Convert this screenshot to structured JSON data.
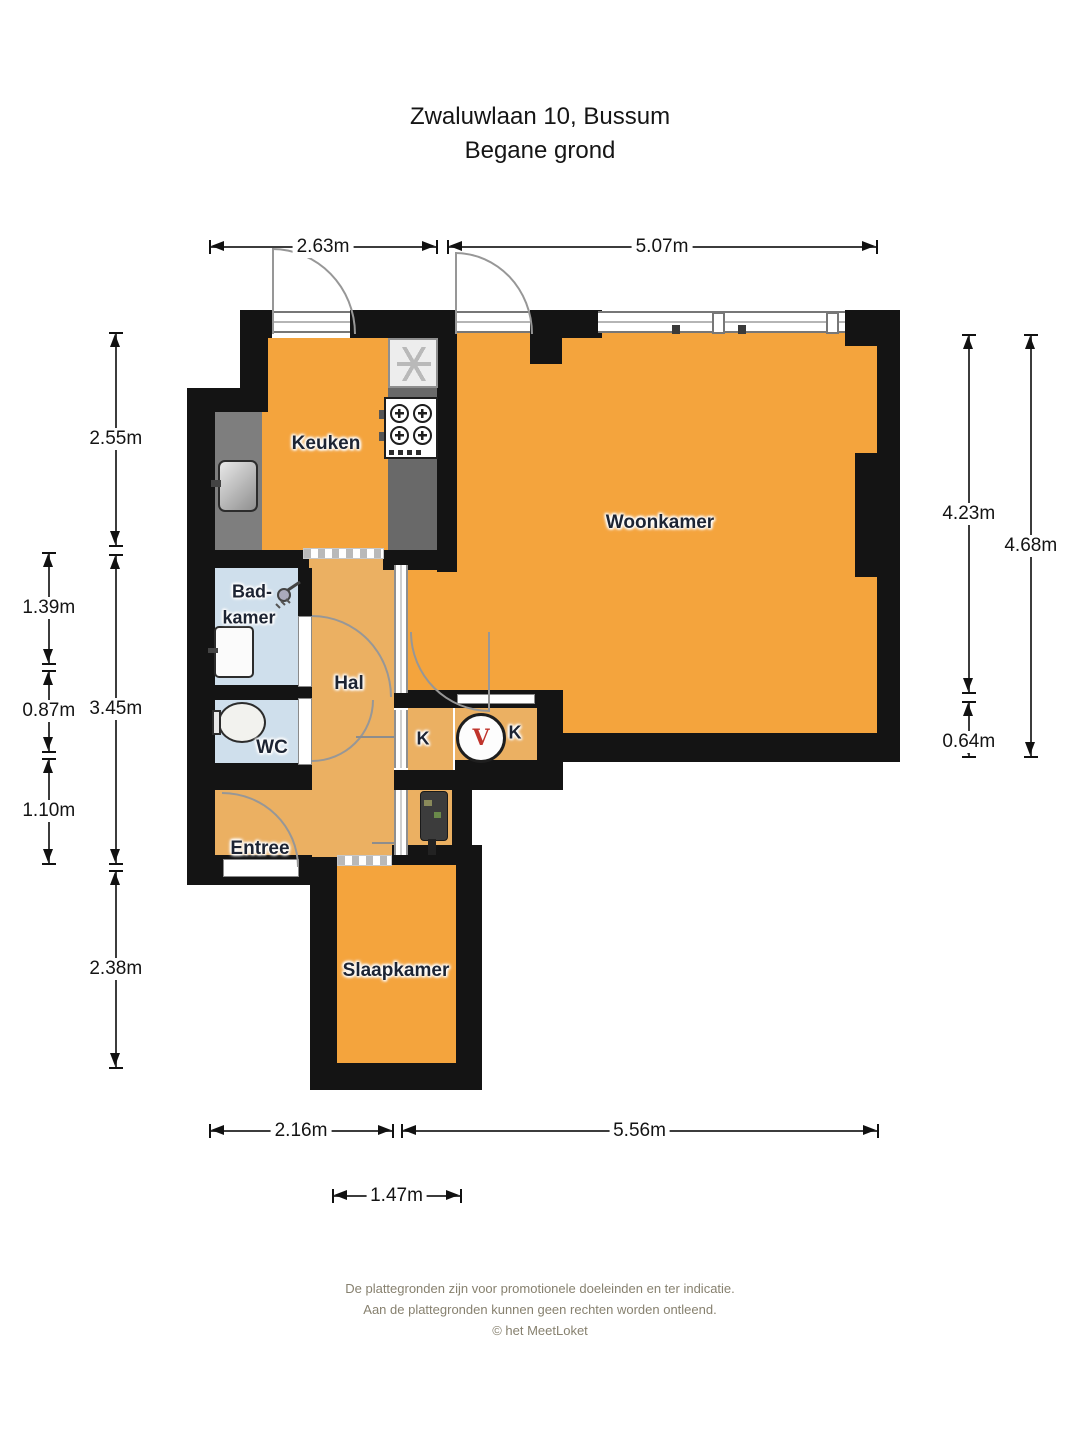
{
  "title": {
    "address": "Zwaluwlaan 10, Bussum",
    "floor": "Begane grond"
  },
  "rooms": {
    "keuken": "Keuken",
    "woonkamer": "Woonkamer",
    "badkamer_line1": "Bad-",
    "badkamer_line2": "kamer",
    "hal": "Hal",
    "wc": "WC",
    "closet_left": "K",
    "closet_right": "K",
    "entree": "Entree",
    "slaapkamer": "Slaapkamer"
  },
  "dimensions": {
    "top_left": "2.63m",
    "top_right": "5.07m",
    "left_outer": [
      "2.55m",
      "3.45m",
      "2.38m"
    ],
    "left_inner": [
      "1.39m",
      "0.87m",
      "1.10m"
    ],
    "right_inner": [
      "4.23m",
      "0.64m"
    ],
    "right_outer": "4.68m",
    "bottom_left": "2.16m",
    "bottom_right": "5.56m",
    "bottom_bedroom": "1.47m"
  },
  "icons": {
    "fridge": "asterisk-icon",
    "ventilation_glyph": "V"
  },
  "footer": {
    "line1": "De plattegronden zijn voor promotionele doeleinden en ter indicatie.",
    "line2": "Aan de plattegronden kunnen geen rechten worden ontleend.",
    "line3": "© het MeetLoket"
  },
  "colors": {
    "room": "#F4A43D",
    "hall": "#EBB062",
    "wet": "#CFDFEC",
    "wall": "#141414",
    "counter": "#7E7E7E",
    "counterdark": "#696969",
    "red": "#C0342C"
  }
}
